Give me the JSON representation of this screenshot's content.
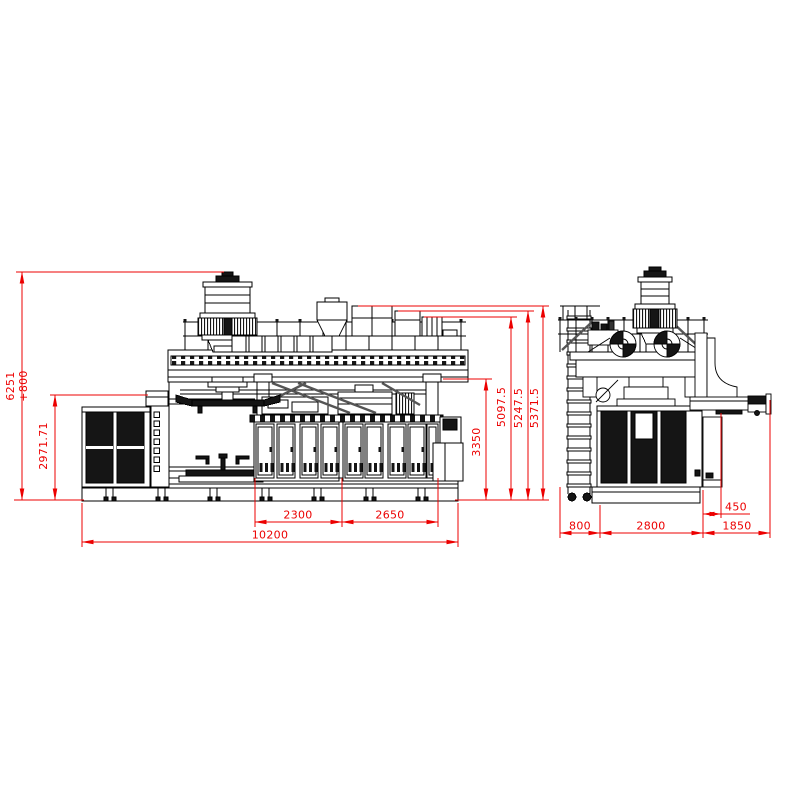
{
  "drawing": {
    "background": "#ffffff",
    "line_color": "#000000",
    "dim_color": "#ec0000",
    "dimensions": {
      "overall_height": "6251",
      "overall_height_offset": "+800",
      "front_section_height": "2971.71",
      "enclosure_height": "3350",
      "platform_height": "5097.5",
      "hopper_height": "5247.5",
      "guardrail_height": "5371.5",
      "mold_bay_width": "2300",
      "clamp_bay_width": "2650",
      "overall_length": "10200",
      "conveyor_side_offset": "450",
      "ladder_depth": "800",
      "body_depth": "2800",
      "conveyor_overhang": "1850"
    }
  }
}
